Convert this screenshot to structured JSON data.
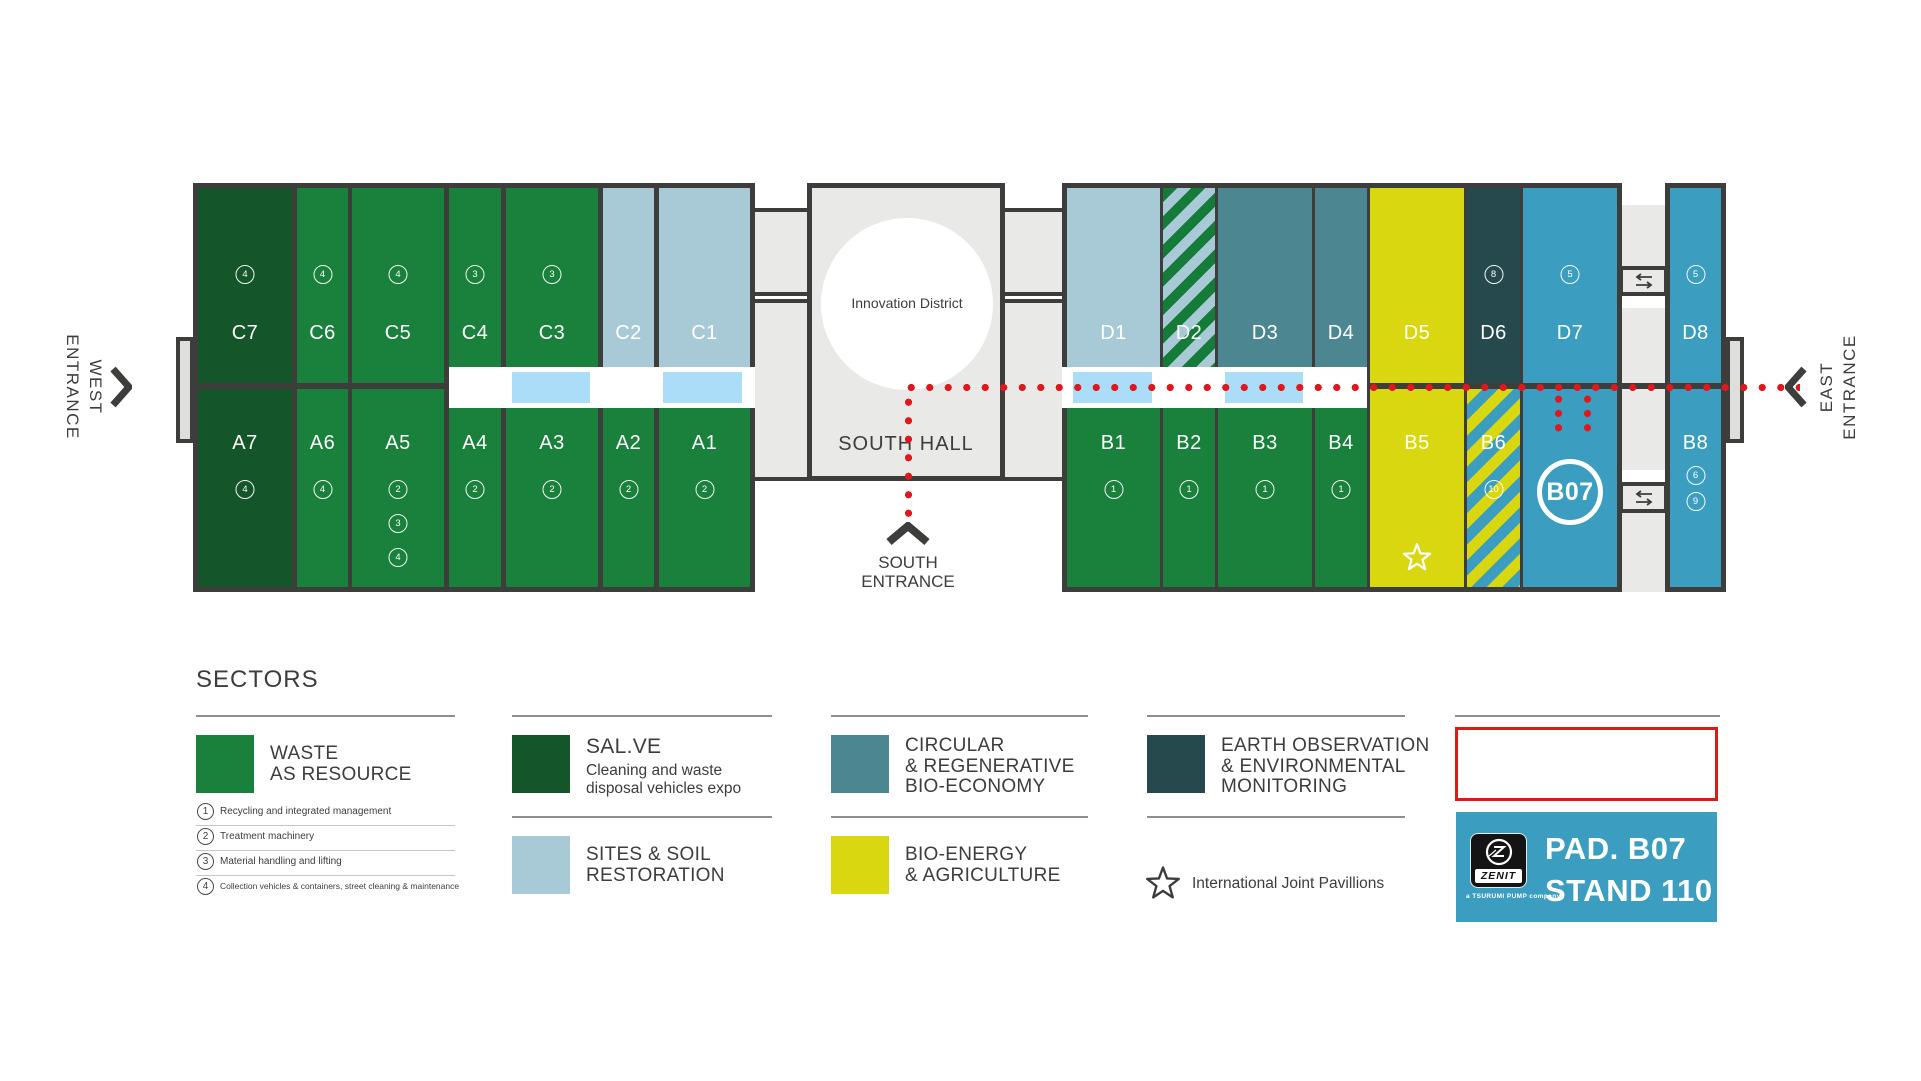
{
  "palette": {
    "green": "#19813C",
    "dark_green": "#14552A",
    "light_blue": "#A7CAD6",
    "sky_blue": "#ABDDF8",
    "teal": "#4C8791",
    "dark_teal": "#26494E",
    "yellow": "#D9D70F",
    "blue": "#3B9EC1",
    "gray_fill": "#E9E9E8",
    "gray_tab": "#DEDEDD",
    "ink": "#3D3D3C",
    "red": "#E0181E",
    "stripe_green": "#147B38",
    "highlight_red": "#E21717"
  },
  "map": {
    "west_entrance": {
      "line1": "WEST",
      "line2": "ENTRANCE"
    },
    "east_entrance": {
      "line1": "EAST",
      "line2": "ENTRANCE"
    },
    "south_entrance": {
      "line1": "SOUTH",
      "line2": "ENTRANCE"
    },
    "south_hall": {
      "title": "SOUTH HALL",
      "innovation": "Innovation District"
    },
    "left_block": {
      "columns": [
        {
          "top": {
            "id": "C7",
            "fill": "dark-green",
            "badges": [
              "4"
            ]
          },
          "bottom": {
            "id": "A7",
            "fill": "dark-green",
            "badges": [
              "4"
            ]
          }
        },
        {
          "top": {
            "id": "C6",
            "fill": "green",
            "badges": [
              "4"
            ]
          },
          "bottom": {
            "id": "A6",
            "fill": "green",
            "badges": [
              "4"
            ]
          }
        },
        {
          "top": {
            "id": "C5",
            "fill": "green",
            "badges": [
              "4"
            ]
          },
          "bottom": {
            "id": "A5",
            "fill": "green",
            "badges": [
              "2",
              "3",
              "4"
            ]
          }
        },
        {
          "top": {
            "id": "C4",
            "fill": "green",
            "badges": [
              "3"
            ]
          },
          "bottom": {
            "id": "A4",
            "fill": "green",
            "badges": [
              "2"
            ]
          }
        },
        {
          "top": {
            "id": "C3",
            "fill": "green",
            "badges": [
              "3"
            ]
          },
          "bottom": {
            "id": "A3",
            "fill": "green",
            "badges": [
              "2"
            ]
          }
        },
        {
          "top": {
            "id": "C2",
            "fill": "light-blue",
            "badges": []
          },
          "bottom": {
            "id": "A2",
            "fill": "green",
            "badges": [
              "2"
            ]
          }
        },
        {
          "top": {
            "id": "C1",
            "fill": "light-blue",
            "badges": []
          },
          "bottom": {
            "id": "A1",
            "fill": "green",
            "badges": [
              "2"
            ]
          }
        }
      ]
    },
    "right_block": {
      "columns": [
        {
          "top": {
            "id": "D1",
            "fill": "light-blue",
            "badges": []
          },
          "bottom": {
            "id": "B1",
            "fill": "green",
            "badges": [
              "1"
            ]
          }
        },
        {
          "top": {
            "id": "D2",
            "fill": "stripes-green-blue",
            "badges": []
          },
          "bottom": {
            "id": "B2",
            "fill": "green",
            "badges": [
              "1"
            ]
          }
        },
        {
          "top": {
            "id": "D3",
            "fill": "teal",
            "badges": []
          },
          "bottom": {
            "id": "B3",
            "fill": "green",
            "badges": [
              "1"
            ]
          }
        },
        {
          "top": {
            "id": "D4",
            "fill": "teal",
            "badges": []
          },
          "bottom": {
            "id": "B4",
            "fill": "green",
            "badges": [
              "1"
            ]
          }
        },
        {
          "top": {
            "id": "D5",
            "fill": "yellow",
            "badges": []
          },
          "bottom": {
            "id": "B5",
            "fill": "yellow",
            "badges": [],
            "star": true
          }
        },
        {
          "top": {
            "id": "D6",
            "fill": "dark-teal",
            "badges": [
              "8"
            ]
          },
          "bottom": {
            "id": "B6",
            "fill": "stripes-yellow-blue",
            "badges": [
              "10"
            ]
          }
        },
        {
          "top": {
            "id": "D7",
            "fill": "blue",
            "badges": [
              "5"
            ]
          },
          "bottom": {
            "id": "B07",
            "fill": "blue",
            "badges": [],
            "circle_label": "B07"
          }
        }
      ]
    },
    "d8_block": {
      "top": {
        "id": "D8",
        "badges": [
          "5"
        ]
      },
      "bottom": {
        "id": "B8",
        "badges": [
          "6",
          "9"
        ]
      }
    }
  },
  "legend": {
    "title": "SECTORS",
    "list_items": [
      {
        "num": "1",
        "text": "Recycling and integrated management"
      },
      {
        "num": "2",
        "text": "Treatment machinery"
      },
      {
        "num": "3",
        "text": "Material handling and lifting"
      },
      {
        "num": "4",
        "text": "Collection vehicles & containers, street cleaning & maintenance"
      }
    ],
    "sectors": [
      {
        "id": "waste",
        "swatch": "green",
        "lines": [
          "WASTE",
          "AS RESOURCE"
        ],
        "col": 0,
        "row": 0
      },
      {
        "id": "salve",
        "swatch": "dark-green",
        "lines": [
          "SAL.VE"
        ],
        "desc": [
          "Cleaning and waste",
          "disposal vehicles expo"
        ],
        "col": 1,
        "row": 0
      },
      {
        "id": "sites",
        "swatch": "light-blue",
        "lines": [
          "SITES & SOIL",
          "RESTORATION"
        ],
        "col": 1,
        "row": 1
      },
      {
        "id": "circular",
        "swatch": "teal",
        "lines": [
          "CIRCULAR",
          "& REGENERATIVE",
          "BIO-ECONOMY"
        ],
        "col": 2,
        "row": 0
      },
      {
        "id": "bioenergy",
        "swatch": "yellow",
        "lines": [
          "BIO-ENERGY",
          "& AGRICULTURE"
        ],
        "col": 2,
        "row": 1
      },
      {
        "id": "earth",
        "swatch": "dark-teal",
        "lines": [
          "EARTH OBSERVATION",
          "& ENVIRONMENTAL",
          "MONITORING"
        ],
        "col": 3,
        "row": 0
      },
      {
        "id": "water",
        "swatch": "blue",
        "lines": [
          "WATER CYCLE",
          "& BLUE ECONOMY"
        ],
        "col": 4,
        "row": 0,
        "highlighted": true
      }
    ],
    "joint_pavillions": "International Joint Pavillions",
    "stand": {
      "pad": "PAD. B07",
      "stand": "STAND 110",
      "logo": "ZENIT",
      "tagline": "a TSURUMI PUMP company"
    }
  }
}
